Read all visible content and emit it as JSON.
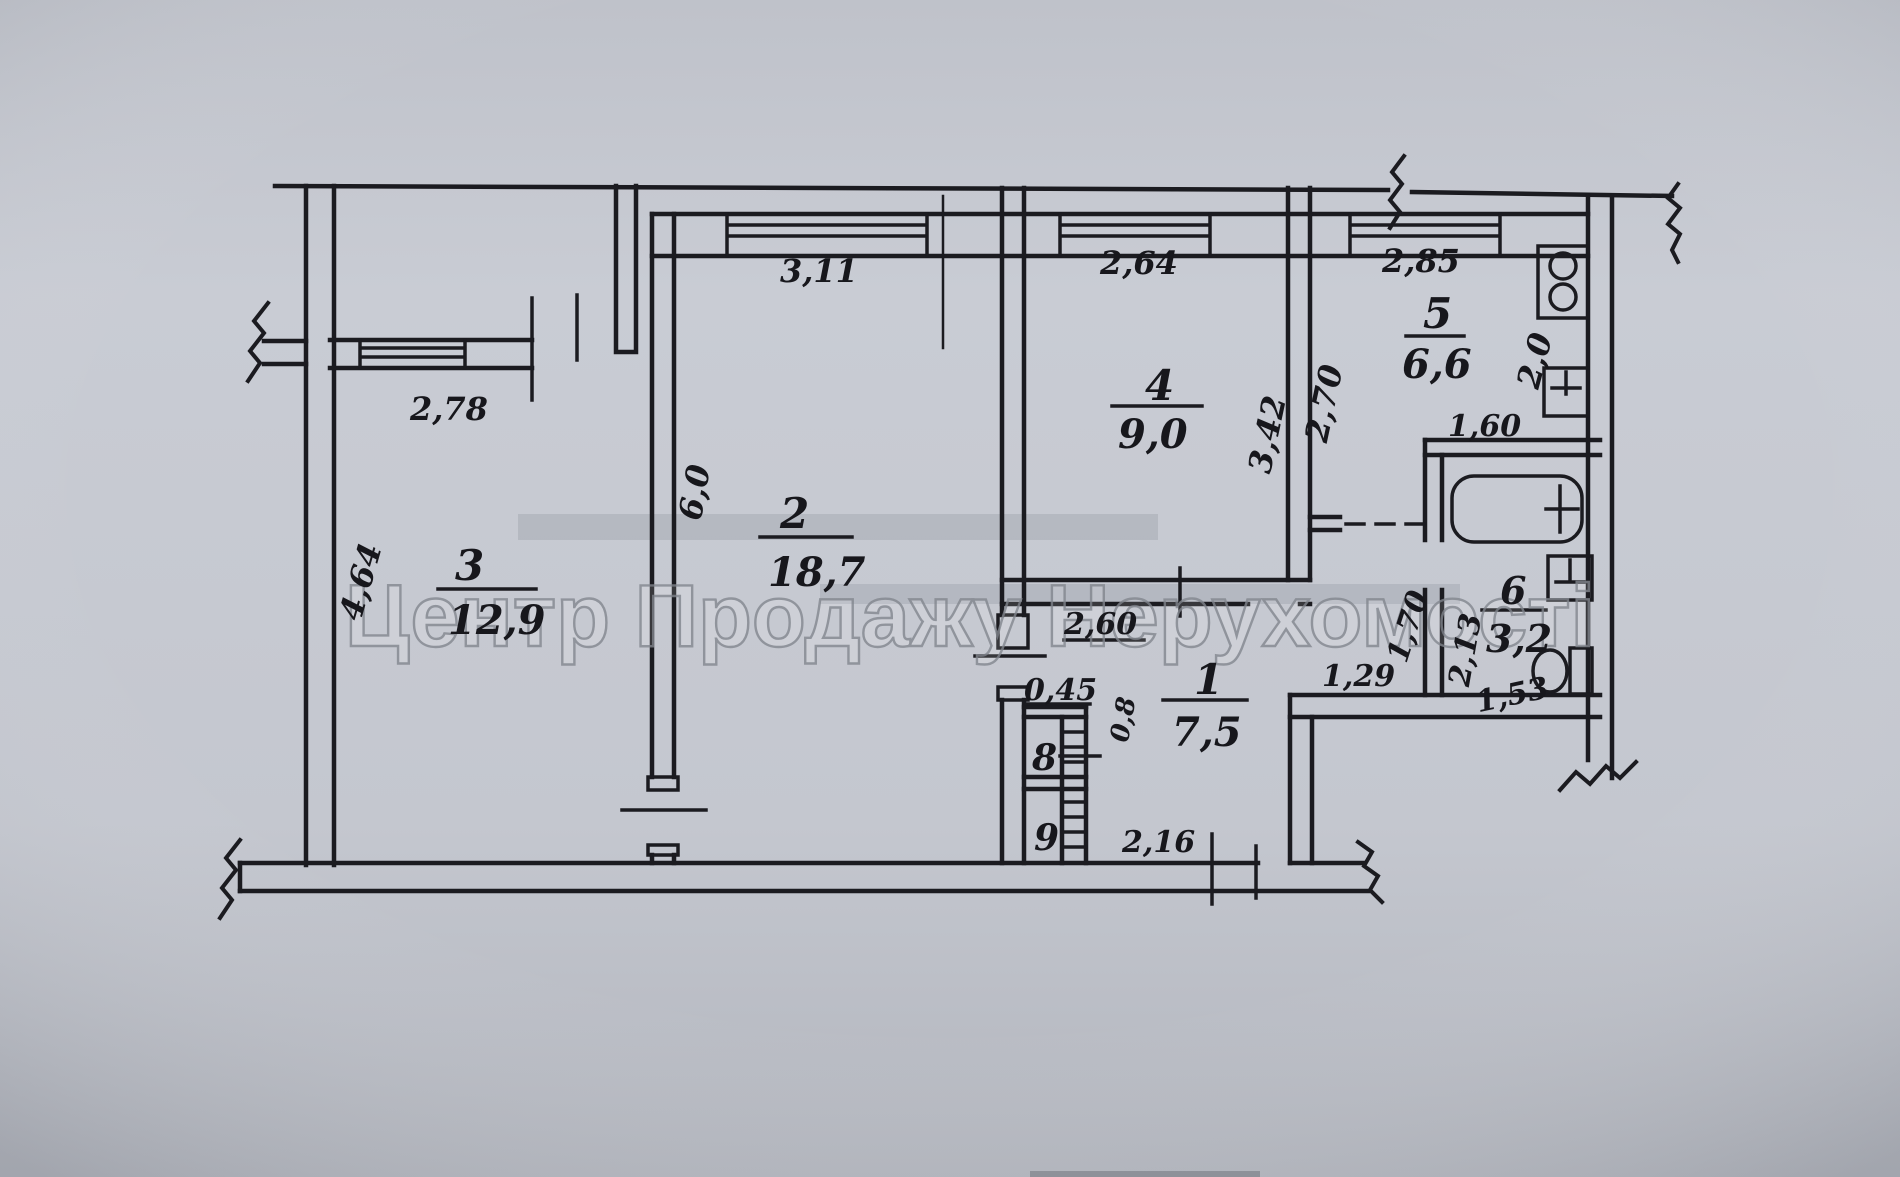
{
  "document": {
    "type": "scanned apartment floor plan (BTI technical plan)",
    "watermark": "Центр Продажу Нерухомості"
  },
  "colors": {
    "paper": "#c6c9d1",
    "ink": "#1b1b20",
    "watermark_gray": "#83878f"
  },
  "rooms": [
    {
      "number": "1",
      "area": "7,5"
    },
    {
      "number": "2",
      "area": "18,7"
    },
    {
      "number": "3",
      "area": "12,9"
    },
    {
      "number": "4",
      "area": "9,0"
    },
    {
      "number": "5",
      "area": "6,6"
    },
    {
      "number": "6",
      "area": "3,2"
    },
    {
      "number": "8"
    },
    {
      "number": "9"
    }
  ],
  "dimensions": {
    "loggia_width": "2,78",
    "room2_width": "3,11",
    "room4_width": "2,64",
    "kitchen_width": "2,85",
    "room3_depth": "4,64",
    "room2_depth": "6,0",
    "room4_depth": "3,42",
    "kitchen_depth_left": "2,70",
    "kitchen_depth_right": "2,0",
    "kitchen_nook_width": "1,60",
    "hall_top_width": "2,60",
    "closet_depth": "0,45",
    "door_width": "0,8",
    "hall_bottom_width": "2,16",
    "corridor_width": "1,29",
    "bath_corridor_depth": "1,70",
    "bath_depth": "2,13",
    "bath_width": "1,53"
  }
}
